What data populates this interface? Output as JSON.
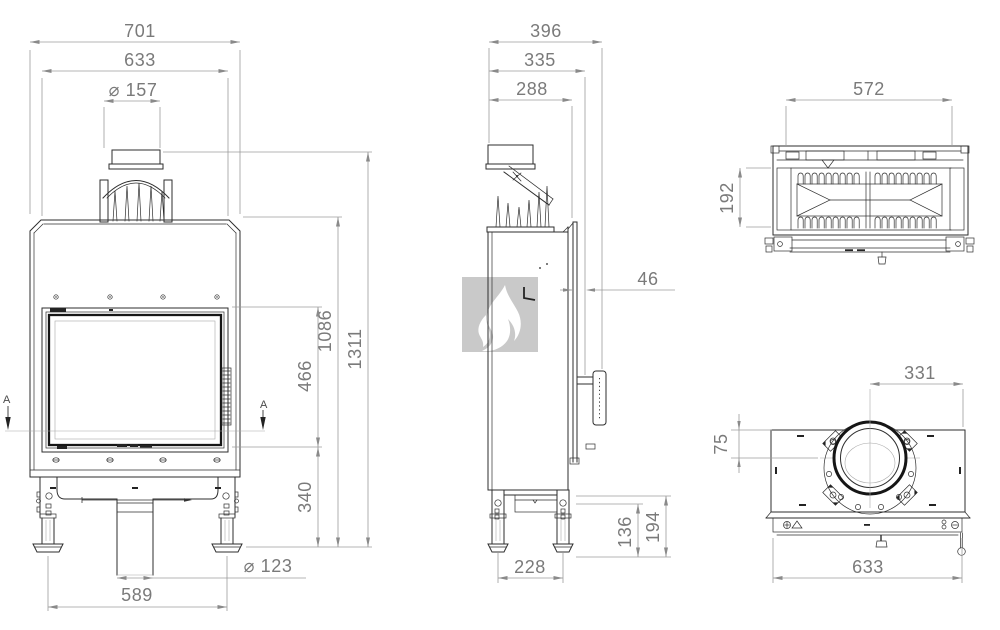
{
  "front_view": {
    "overall_width": "701",
    "body_width": "633",
    "flue_diameter": "⌀ 157",
    "glass_height": "466",
    "body_height": "1086",
    "overall_height": "1311",
    "base_height": "340",
    "feet_spacing": "589",
    "intake_diameter": "⌀ 123",
    "section_label_left": "A",
    "section_label_right": "A"
  },
  "side_view": {
    "overall_depth": "396",
    "body_depth": "335",
    "firebox_depth": "288",
    "door_offset": "46",
    "base_inner_height": "136",
    "base_outer_height": "194",
    "leg_spacing": "228"
  },
  "section_view": {
    "inner_width": "572",
    "inner_depth": "192"
  },
  "top_view": {
    "flue_center_from_edge": "331",
    "flue_edge_from_front": "75",
    "body_width": "633"
  },
  "colors": {
    "background": "#ffffff",
    "drawing_line": "#2e2e2e",
    "dimension_line": "#9b9b9b",
    "dimension_text": "#7a7a7a",
    "watermark_gray": "#c9c9c9"
  }
}
